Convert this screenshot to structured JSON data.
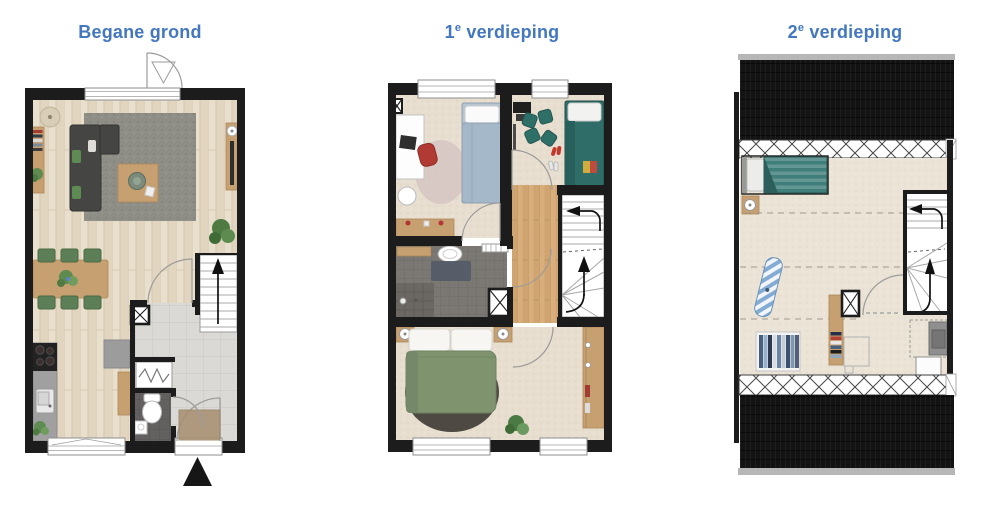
{
  "page": {
    "background": "#ffffff"
  },
  "titles": {
    "ground": "Begane grond",
    "first_num": "1",
    "first_sup": "e",
    "first_rest": " verdieping",
    "second_num": "2",
    "second_sup": "e",
    "second_rest": " verdieping",
    "color": "#4377c0"
  },
  "colors": {
    "wall": "#1c1c1c",
    "wood_floor": "#e8ddcb",
    "landing_wood": "#d8ae7c",
    "hall_tile": "#dbd9d5",
    "toilet_tile": "#626160",
    "bathroom_tile": "#7b7874",
    "carpet": "#e7decf",
    "rug_gray": "#8e8e86",
    "sofa": "#454543",
    "furniture_wood": "#c7a071",
    "chair_green": "#5d7f57",
    "bed_blue": "#a4b8ca",
    "bed_teal": "#2f6e68",
    "duvet_green": "#7e936e",
    "roof_black": "#131313",
    "ironing_blue": "#83abd3"
  },
  "floors": [
    {
      "label": "Begane grond",
      "elements": [
        "living-room",
        "kitchen",
        "hallway",
        "toilet",
        "straight-staircase-up-arrow",
        "back-door",
        "front-door",
        "entrance-triangle",
        "corner-sofa",
        "area-rug",
        "coffee-table",
        "dining-table",
        "six-dining-chairs",
        "sideboard-left",
        "sideboard-right",
        "floor-lamp",
        "cooktop",
        "kitchen-sink",
        "wc",
        "hand-basin",
        "radiator",
        "shaft",
        "doormat",
        "plants"
      ]
    },
    {
      "label": "1e verdieping",
      "elements": [
        "bedroom-1",
        "bedroom-2",
        "bathroom",
        "landing",
        "master-bedroom",
        "winder-staircase",
        "desk",
        "desk-chair",
        "round-rug",
        "single-bed-blue",
        "dresser",
        "wall-tv",
        "poufs",
        "single-bed-teal",
        "washbasin",
        "bath-mat",
        "shower",
        "radiator",
        "shaft",
        "double-bed-green",
        "nightstands",
        "round-carpet",
        "wardrobe",
        "plant",
        "windows"
      ]
    },
    {
      "label": "2e verdieping",
      "elements": [
        "attic-room",
        "roof-planes",
        "lattice-roof-edge",
        "single-bed-teal-striped",
        "nightstand-lamp",
        "headroom-dashed-lines",
        "winder-staircase",
        "door",
        "shaft",
        "bookshelf",
        "ironing-board",
        "storage-rack",
        "washing-machine",
        "appliance-outline"
      ]
    }
  ]
}
